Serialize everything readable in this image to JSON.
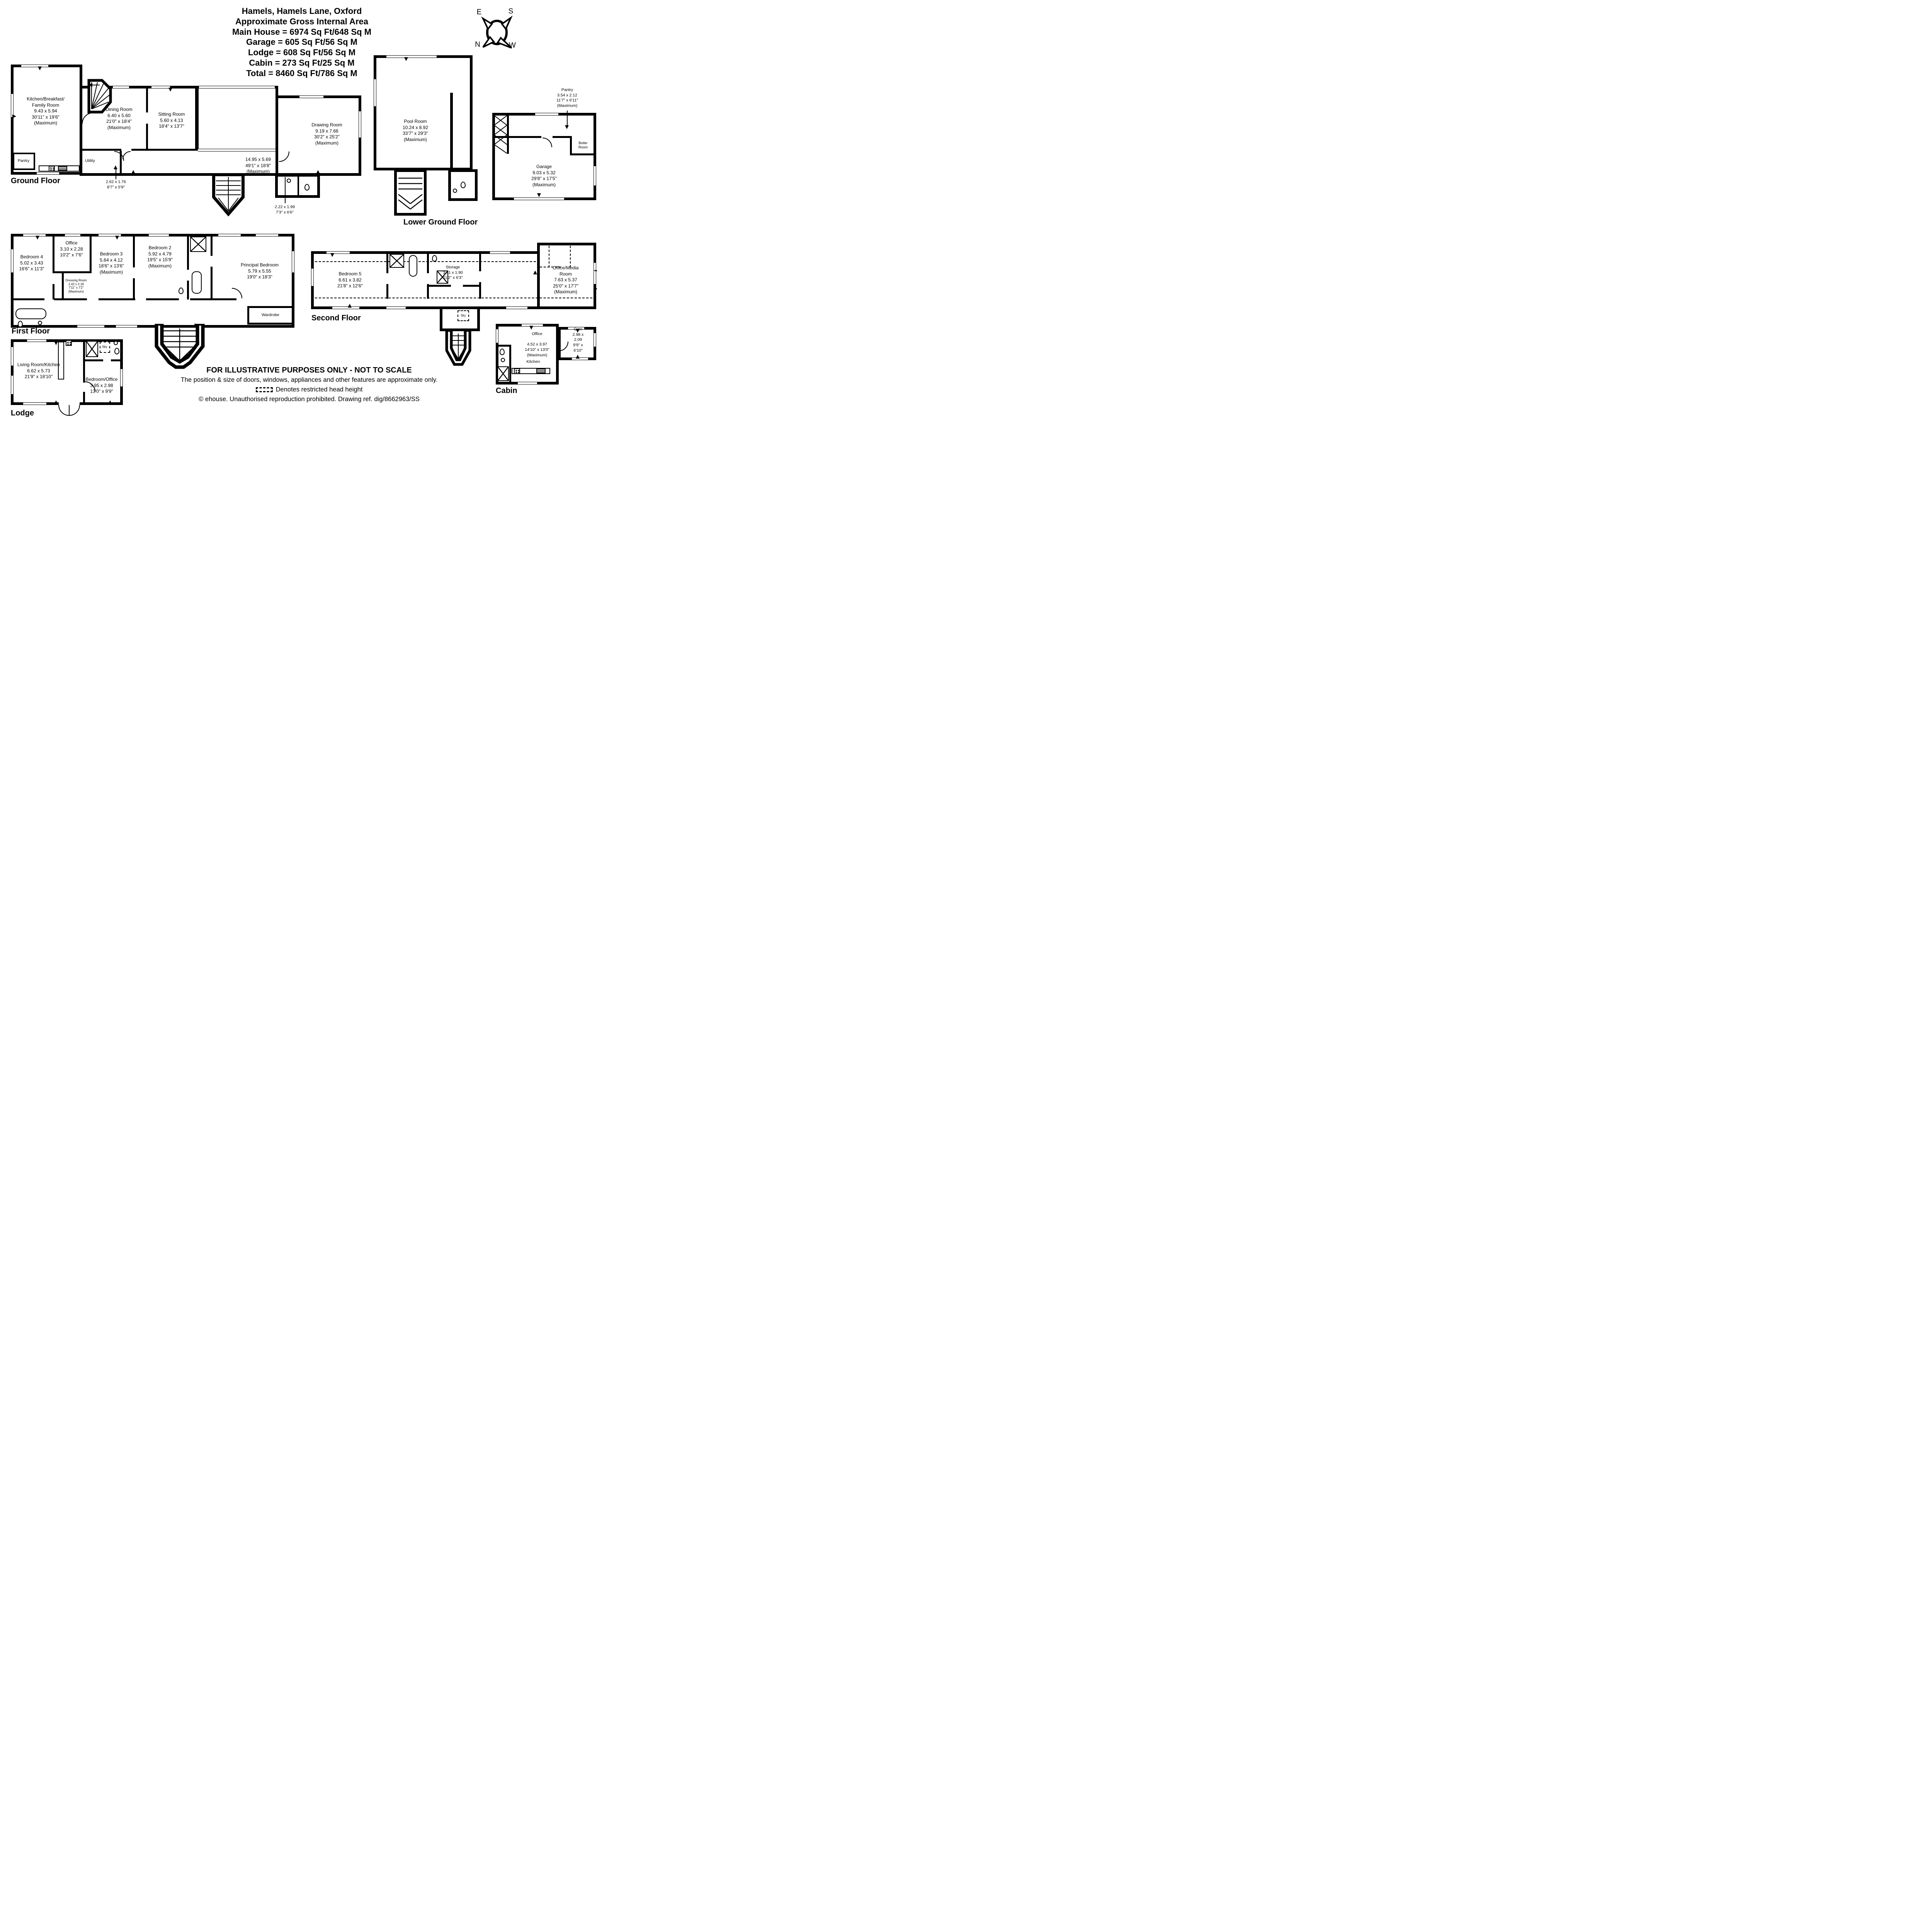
{
  "title": {
    "lines": [
      "Hamels, Hamels Lane, Oxford",
      "Approximate Gross Internal Area",
      "Main House = 6974 Sq Ft/648 Sq M",
      "Garage = 605 Sq Ft/56 Sq M",
      "Lodge = 608 Sq Ft/56 Sq M",
      "Cabin = 273 Sq Ft/25 Sq M",
      "Total = 8460 Sq Ft/786 Sq M"
    ]
  },
  "compass": {
    "east": "E",
    "south": "S",
    "north": "N",
    "west": "W"
  },
  "floors": {
    "ground": {
      "label": "Ground Floor",
      "rooms": {
        "kitchen": [
          "Kitchen/Breakfast/",
          "Family Room",
          "9.43 x 5.94",
          "30'11\" x 19'6\"",
          "(Maximum)"
        ],
        "dining": [
          "Dining Room",
          "6.40 x 5.60",
          "21'0\" x 18'4\"",
          "(Maximum)"
        ],
        "sitting": [
          "Sitting Room",
          "5.60 x 4.13",
          "18'4\" x 13'7\""
        ],
        "drawing": [
          "Drawing Room",
          "9.19 x 7.66",
          "30'2\" x 25'2\"",
          "(Maximum)"
        ],
        "hall": [
          "14.95 x 5.69",
          "49'1\" x 18'8\"",
          "(Maximum)"
        ],
        "pantry": [
          "Pantry"
        ],
        "utility": [
          "Utility"
        ],
        "lobby": [
          "2.62 x 1.76",
          "8'7\" x 5'9\""
        ],
        "wc_lobby": [
          "2.22 x 1.99",
          "7'3\" x 6'6\""
        ]
      }
    },
    "lower_ground": {
      "label": "Lower Ground Floor",
      "rooms": {
        "pool": [
          "Pool Room",
          "10.24 x 8.92",
          "33'7\" x 29'3\"",
          "(Maximum)"
        ]
      }
    },
    "outbuilding": {
      "rooms": {
        "pantry": [
          "Pantry",
          "3.54 x 2.12",
          "11'7\" x 6'11\"",
          "(Maximum)"
        ],
        "boiler": [
          "Boiler",
          "Room"
        ],
        "garage": [
          "Garage",
          "9.03 x 5.32",
          "29'8\" x 17'5\"",
          "(Maximum)"
        ]
      }
    },
    "first": {
      "label": "First Floor",
      "rooms": {
        "bedroom4": [
          "Bedroom 4",
          "5.02 x 3.43",
          "16'6\" x 11'3\""
        ],
        "office": [
          "Office",
          "3.10 x 2.28",
          "10'2\" x 7'6\""
        ],
        "bedroom3": [
          "Bedroom 3",
          "5.64 x 4.12",
          "18'6\" x 13'6\"",
          "(Maximum)"
        ],
        "dressing": [
          "Dressing Room",
          "2.42 x 2.18",
          "7'11\" x 7'2\"",
          "(Maximum)"
        ],
        "bedroom2": [
          "Bedroom 2",
          "5.92 x 4.79",
          "19'5\" x 15'9\"",
          "(Maximum)"
        ],
        "principal": [
          "Principal Bedroom",
          "5.79 x 5.55",
          "19'0\" x 18'3\""
        ],
        "wardrobe": [
          "Wardrobe"
        ]
      }
    },
    "second": {
      "label": "Second Floor",
      "rooms": {
        "bedroom5": [
          "Bedroom 5",
          "6.61 x 3.82",
          "21'8\" x 12'6\""
        ],
        "storage": [
          "Storage",
          "3.41 x 1.90",
          "11'2\" x 6'3\""
        ],
        "office_media": [
          "Office/Media Room",
          "7.63 x 5.37",
          "25'0\" x 17'7\"",
          "(Maximum)"
        ],
        "sky": [
          "Sky"
        ]
      }
    },
    "lodge": {
      "label": "Lodge",
      "rooms": {
        "living": [
          "Living Room/Kitchen",
          "6.62 x 5.73",
          "21'9\" x 18'10\""
        ],
        "bedroom_office": [
          "Bedroom/Office",
          "3.95 x 2.98",
          "13'0\" x 9'9\""
        ],
        "sky": [
          "Sky"
        ]
      }
    },
    "cabin": {
      "label": "Cabin",
      "rooms": {
        "office": [
          "Office",
          "",
          "4.52 x 3.97",
          "14'10\" x 13'0\"",
          "(Maximum)"
        ],
        "kitchen": [
          "Kitchen"
        ],
        "gym": [
          "Gym",
          "2.98 x 2.09",
          "9'9\" x 6'10\""
        ]
      }
    }
  },
  "footer": {
    "lines": [
      "FOR ILLUSTRATIVE PURPOSES ONLY - NOT TO SCALE",
      "The position & size of doors, windows, appliances and other features are approximate only.",
      "Denotes restricted head height",
      "© ehouse. Unauthorised reproduction prohibited. Drawing ref. dig/8662963/SS"
    ]
  }
}
